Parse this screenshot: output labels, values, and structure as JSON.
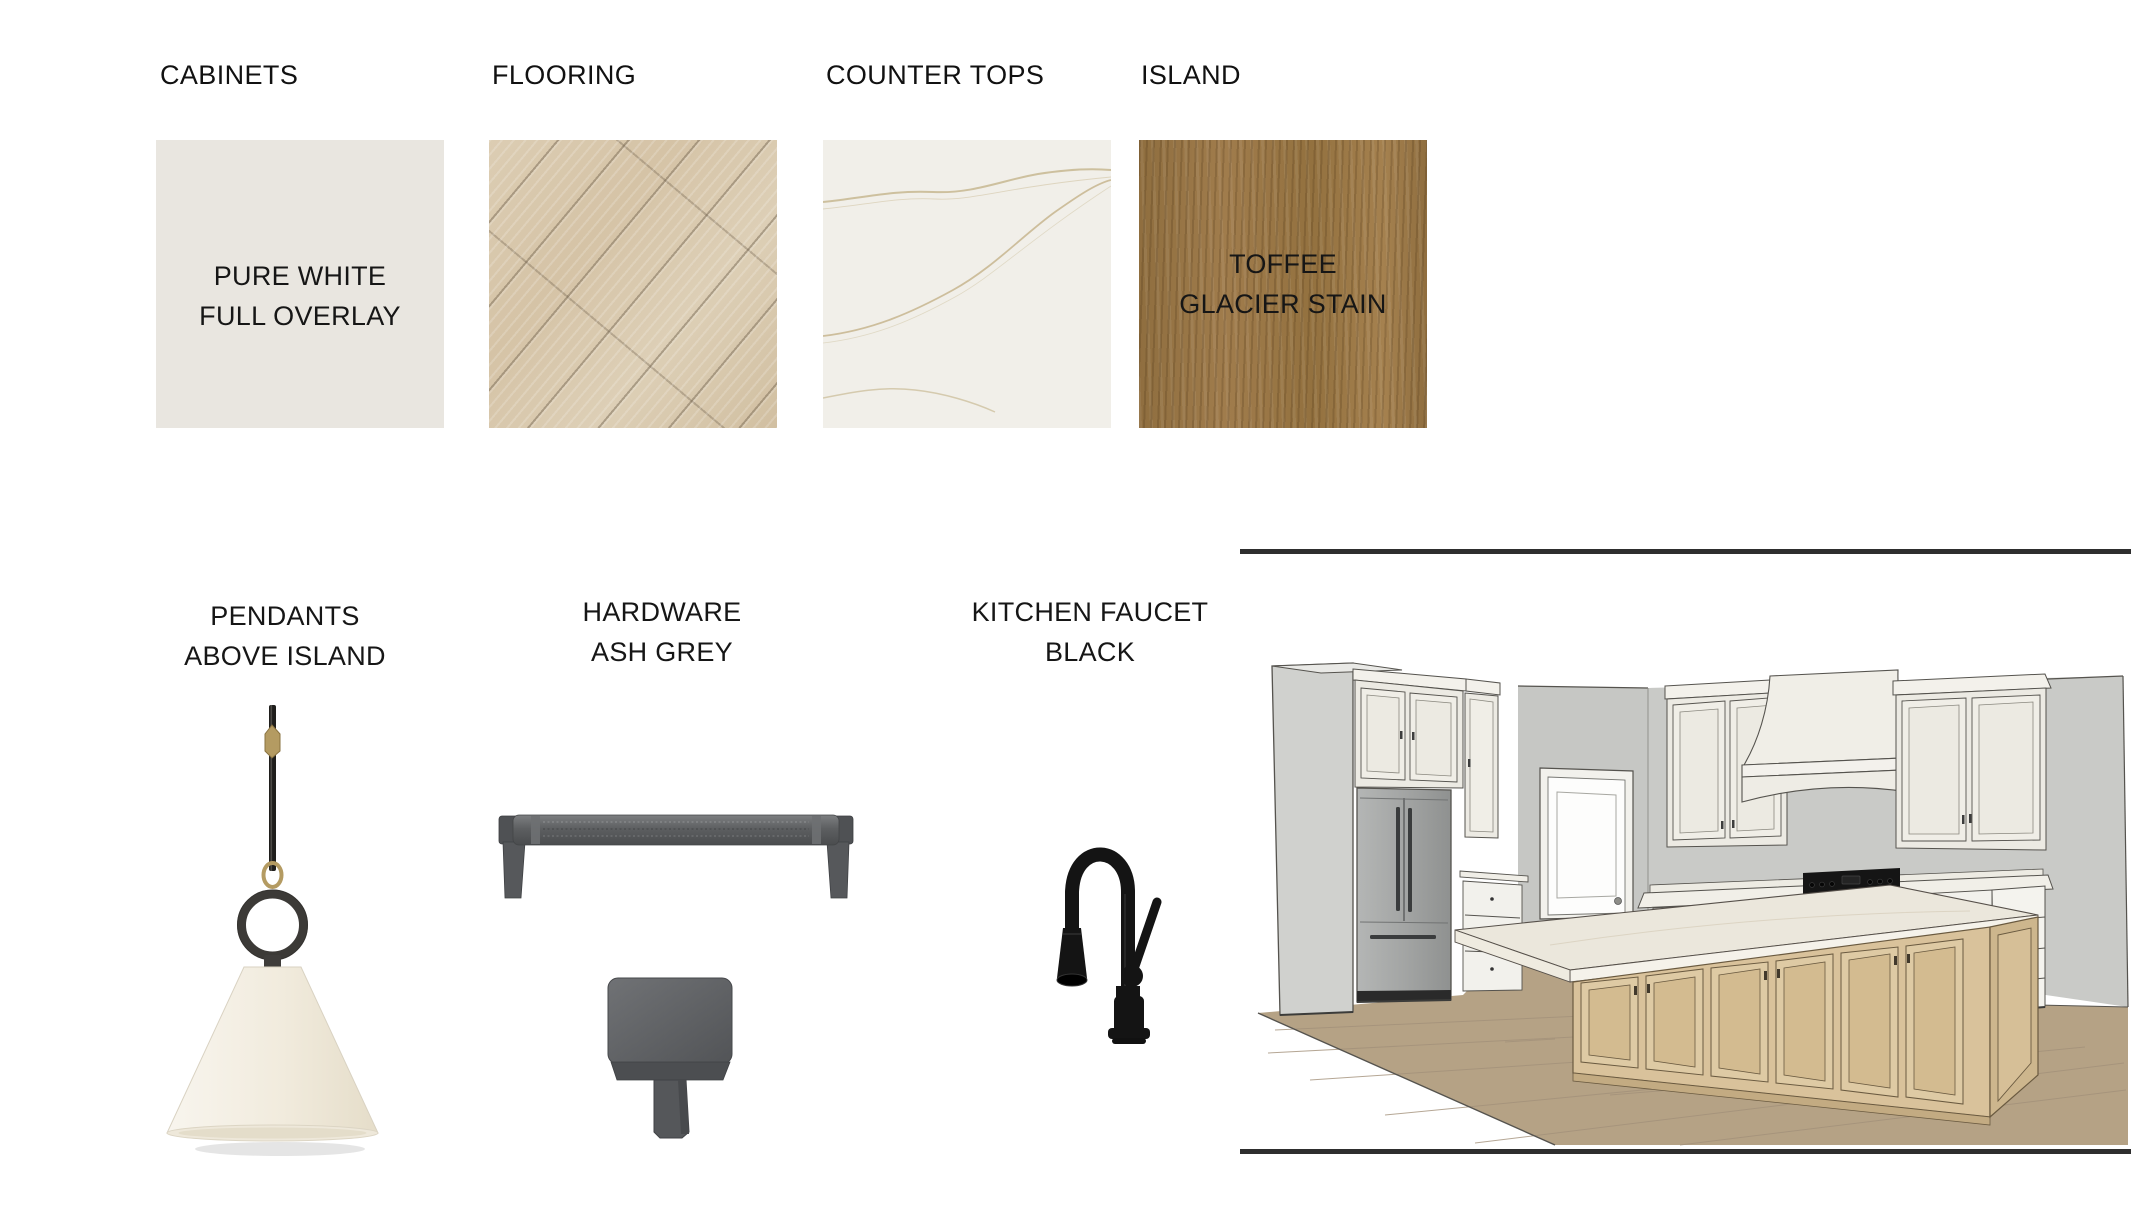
{
  "materials": [
    {
      "id": "cabinets",
      "label": "CABINETS",
      "caption_line1": "PURE WHITE",
      "caption_line2": "FULL OVERLAY",
      "swatch": "flat-paint-sample",
      "color": "#E9E6E0"
    },
    {
      "id": "flooring",
      "label": "FLOORING",
      "swatch": "light-oak-diagonal-planks",
      "color": "#D8C7AC"
    },
    {
      "id": "countertops",
      "label": "COUNTER TOPS",
      "swatch": "white-quartz-with-veining",
      "color": "#F1EFE9",
      "vein_color": "#C6B28C"
    },
    {
      "id": "island",
      "label": "ISLAND",
      "caption_line1": "TOFFEE",
      "caption_line2": "GLACIER STAIN",
      "swatch": "stained-wood-sample",
      "color": "#9B7848"
    }
  ],
  "fixtures": [
    {
      "id": "pendants",
      "label_line1": "PENDANTS",
      "label_line2": "ABOVE ISLAND",
      "shade_color": "#F4F0E7",
      "accent_color": "#B49B62"
    },
    {
      "id": "hardware",
      "label_line1": "HARDWARE",
      "label_line2": "ASH GREY",
      "finish_color": "#5E6063"
    },
    {
      "id": "faucet",
      "label_line1": "KITCHEN FAUCET",
      "label_line2": "BLACK",
      "finish_color": "#141414"
    }
  ],
  "rendering": {
    "divider_color": "#2E2E2E",
    "wall_color": "#C7C8C5",
    "cabinet_color": "#F0EEE7",
    "island_wood_color": "#D9C29B",
    "floor_color": "#B5A285",
    "counter_color": "#F1EFE8",
    "range_color": "#151515",
    "fridge_color": "#A3A5A4"
  }
}
